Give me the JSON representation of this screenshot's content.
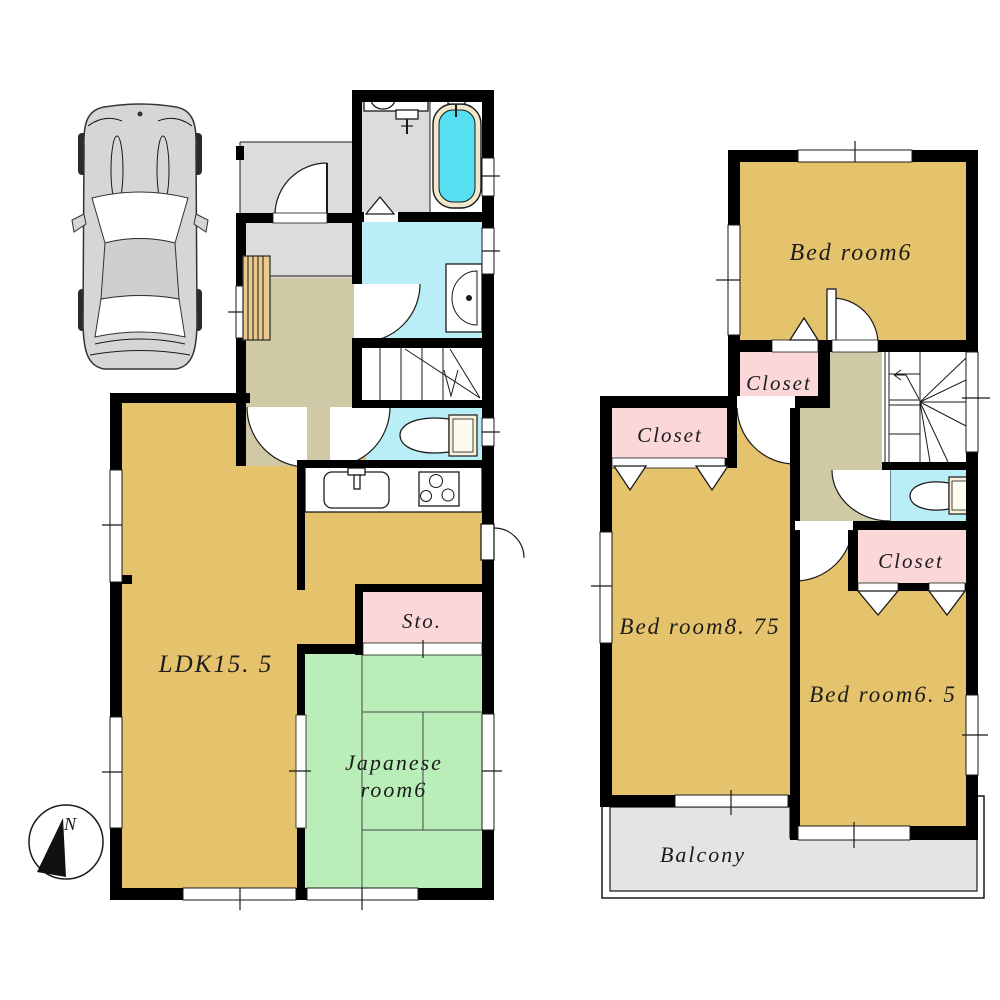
{
  "floorplan": {
    "first_floor": {
      "rooms": {
        "ldk": "LDK15. 5",
        "japanese_room_line1": "Japanese",
        "japanese_room_line2": "room6",
        "storage": "Sto."
      }
    },
    "second_floor": {
      "rooms": {
        "bedroom_a": "Bed room6",
        "bedroom_b": "Bed room8. 75",
        "bedroom_c": "Bed room6. 5",
        "closet_a": "Closet",
        "closet_b": "Closet",
        "closet_c": "Closet",
        "balcony": "Balcony"
      }
    },
    "compass": {
      "north": "N"
    },
    "colors": {
      "wall": "#000000",
      "room_tan": "#e5c36c",
      "tatami_green": "#b9eeb9",
      "closet_pink": "#fbd7d9",
      "wet_cyan": "#baeef7",
      "tub_cyan": "#55dff0",
      "tub_rim": "#efe8cc",
      "entry_gray": "#dcdcdc",
      "hall_olive": "#cfc9a5",
      "balcony_gray": "#e4e4e4",
      "wood": "#eac98e",
      "car_gray": "#d6d6d6"
    }
  }
}
